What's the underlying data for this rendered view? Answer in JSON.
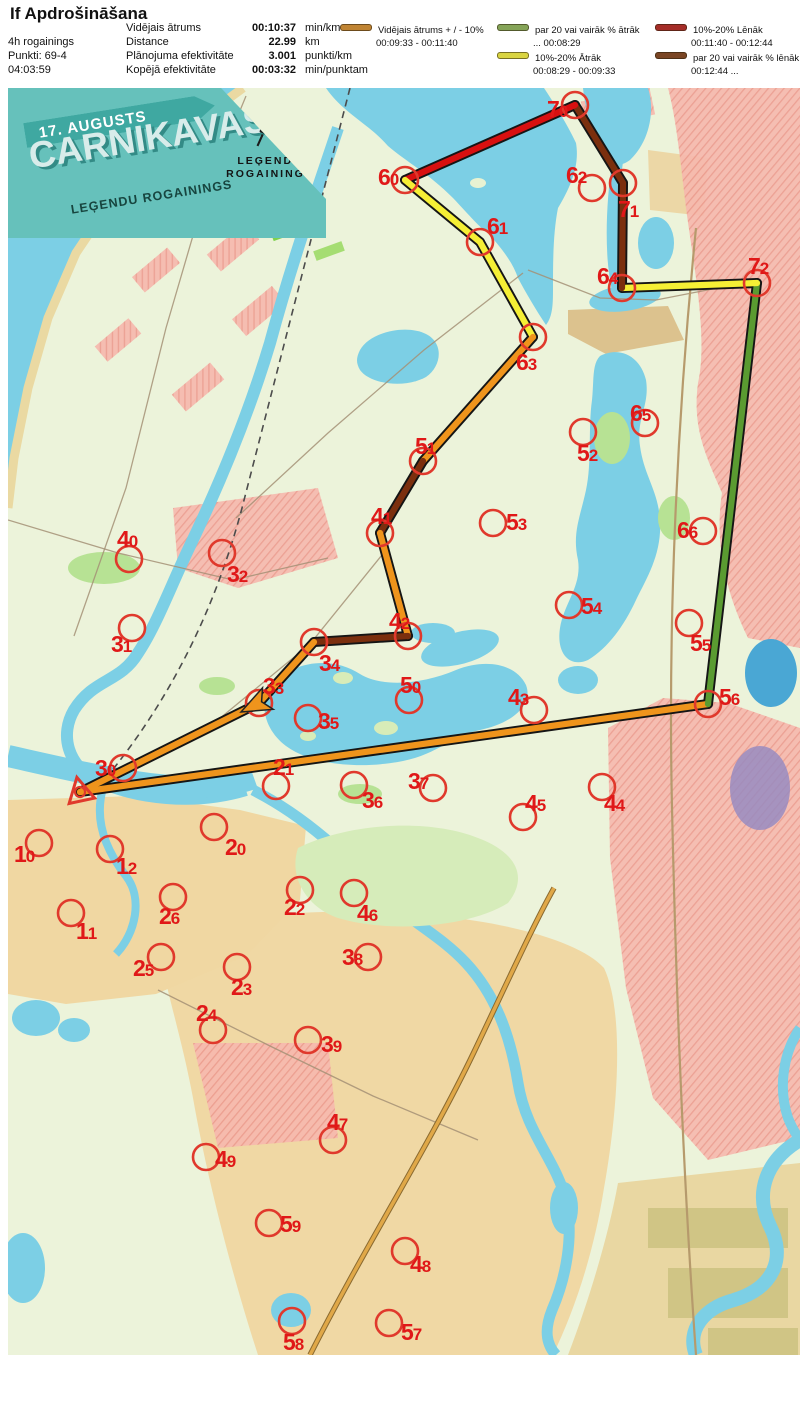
{
  "header": {
    "title": "If Apdrošināšana",
    "left": {
      "line1": "4h rogainings",
      "line2": "Punkti: 69-4",
      "line3": "04:03:59"
    },
    "stats": [
      {
        "label": "Vidējais ātrums",
        "value": "00:10:37",
        "unit": "min/km"
      },
      {
        "label": "Distance",
        "value": "22.99",
        "unit": "km"
      },
      {
        "label": "Plānojuma efektivitāte",
        "value": "3.001",
        "unit": "punkti/km"
      },
      {
        "label": "Kopējā efektivitāte",
        "value": "00:03:32",
        "unit": "min/punktam"
      }
    ],
    "legend": [
      {
        "label": "Vidējais ātrums + / - 10%",
        "range": "00:09:33   -   00:11:40",
        "color": "#c08433",
        "col": 1,
        "row": 0
      },
      {
        "label": "par 20 vai vairāk % ātrāk",
        "range": "...   00:08:29",
        "color": "#85a458",
        "col": 2,
        "row": 0
      },
      {
        "label": "10%-20% Ātrāk",
        "range": "00:08:29   -   00:09:33",
        "color": "#d9d441",
        "col": 2,
        "row": 1
      },
      {
        "label": "10%-20% Lēnāk",
        "range": "00:11:40   - 00:12:44",
        "color": "#a52d28",
        "col": 3,
        "row": 0
      },
      {
        "label": "par 20 vai vairāk % lēnāk",
        "range": "00:12:44   ...",
        "color": "#7a4524",
        "col": 3,
        "row": 1
      }
    ]
  },
  "banner": {
    "date": "17. AUGUSTS",
    "title": "CARNIKAVAS",
    "subtitle": "LEĢENDU ROGAININGS",
    "logo_line1": "LEĢENDU",
    "logo_line2": "ROGAININGS"
  },
  "map": {
    "route_colors": {
      "orange": "#ef941c",
      "yellow": "#f5ef35",
      "red": "#d81010",
      "brown": "#7b2f0e",
      "green": "#5a9b31"
    },
    "control_circle_color": "#e0392c",
    "label_color": "#e01818",
    "start": {
      "x": 72,
      "y": 704
    },
    "arrow": {
      "x": 233,
      "y": 624,
      "angle": 153.5
    },
    "controls": [
      {
        "id": "10",
        "x": 31,
        "y": 755,
        "lx": 6,
        "lby": 774
      },
      {
        "id": "11",
        "x": 63,
        "y": 825,
        "lx": 68,
        "lby": 851
      },
      {
        "id": "12",
        "x": 102,
        "y": 761,
        "lx": 108,
        "lby": 786
      },
      {
        "id": "20",
        "x": 206,
        "y": 739,
        "lx": 217,
        "lby": 767
      },
      {
        "id": "21",
        "x": 268,
        "y": 698,
        "lx": 265,
        "lby": 687
      },
      {
        "id": "22",
        "x": 292,
        "y": 802,
        "lx": 276,
        "lby": 827
      },
      {
        "id": "23",
        "x": 229,
        "y": 879,
        "lx": 223,
        "lby": 907
      },
      {
        "id": "24",
        "x": 205,
        "y": 942,
        "lx": 188,
        "lby": 933
      },
      {
        "id": "25",
        "x": 153,
        "y": 869,
        "lx": 125,
        "lby": 888
      },
      {
        "id": "26",
        "x": 165,
        "y": 809,
        "lx": 151,
        "lby": 836
      },
      {
        "id": "30",
        "x": 115,
        "y": 680,
        "lx": 87,
        "lby": 688
      },
      {
        "id": "31",
        "x": 124,
        "y": 540,
        "lx": 103,
        "lby": 564
      },
      {
        "id": "32",
        "x": 214,
        "y": 465,
        "lx": 219,
        "lby": 494
      },
      {
        "id": "33",
        "x": 251,
        "y": 615,
        "lx": 255,
        "lby": 606
      },
      {
        "id": "34",
        "x": 306,
        "y": 554,
        "lx": 311,
        "lby": 583
      },
      {
        "id": "35",
        "x": 300,
        "y": 630,
        "lx": 310,
        "lby": 641
      },
      {
        "id": "36",
        "x": 346,
        "y": 697,
        "lx": 354,
        "lby": 720
      },
      {
        "id": "37",
        "x": 425,
        "y": 700,
        "lx": 400,
        "lby": 701
      },
      {
        "id": "38",
        "x": 360,
        "y": 869,
        "lx": 334,
        "lby": 877
      },
      {
        "id": "39",
        "x": 300,
        "y": 952,
        "lx": 313,
        "lby": 964
      },
      {
        "id": "40",
        "x": 121,
        "y": 471,
        "lx": 109,
        "lby": 459
      },
      {
        "id": "41",
        "x": 372,
        "y": 445,
        "lx": 363,
        "lby": 436
      },
      {
        "id": "42",
        "x": 400,
        "y": 548,
        "lx": 381,
        "lby": 541
      },
      {
        "id": "43",
        "x": 526,
        "y": 622,
        "lx": 500,
        "lby": 617
      },
      {
        "id": "44",
        "x": 594,
        "y": 699,
        "lx": 596,
        "lby": 723
      },
      {
        "id": "45",
        "x": 515,
        "y": 729,
        "lx": 517,
        "lby": 723
      },
      {
        "id": "46",
        "x": 346,
        "y": 805,
        "lx": 349,
        "lby": 833
      },
      {
        "id": "47",
        "x": 325,
        "y": 1052,
        "lx": 319,
        "lby": 1042
      },
      {
        "id": "48",
        "x": 397,
        "y": 1163,
        "lx": 402,
        "lby": 1184
      },
      {
        "id": "49",
        "x": 198,
        "y": 1069,
        "lx": 207,
        "lby": 1079
      },
      {
        "id": "50",
        "x": 401,
        "y": 612,
        "lx": 392,
        "lby": 605
      },
      {
        "id": "51",
        "x": 415,
        "y": 373,
        "lx": 407,
        "lby": 366
      },
      {
        "id": "52",
        "x": 575,
        "y": 344,
        "lx": 569,
        "lby": 373
      },
      {
        "id": "53",
        "x": 485,
        "y": 435,
        "lx": 498,
        "lby": 442
      },
      {
        "id": "54",
        "x": 561,
        "y": 517,
        "lx": 573,
        "lby": 526
      },
      {
        "id": "55",
        "x": 681,
        "y": 535,
        "lx": 682,
        "lby": 563
      },
      {
        "id": "56",
        "x": 700,
        "y": 616,
        "lx": 711,
        "lby": 617
      },
      {
        "id": "57",
        "x": 381,
        "y": 1235,
        "lx": 393,
        "lby": 1252
      },
      {
        "id": "58",
        "x": 284,
        "y": 1233,
        "lx": 275,
        "lby": 1262
      },
      {
        "id": "59",
        "x": 261,
        "y": 1135,
        "lx": 272,
        "lby": 1144
      },
      {
        "id": "60",
        "x": 397,
        "y": 92,
        "lx": 370,
        "lby": 97
      },
      {
        "id": "61",
        "x": 472,
        "y": 154,
        "lx": 479,
        "lby": 146
      },
      {
        "id": "62",
        "x": 584,
        "y": 100,
        "lx": 558,
        "lby": 95
      },
      {
        "id": "63",
        "x": 525,
        "y": 249,
        "lx": 508,
        "lby": 282
      },
      {
        "id": "64",
        "x": 614,
        "y": 200,
        "lx": 589,
        "lby": 196
      },
      {
        "id": "65",
        "x": 637,
        "y": 335,
        "lx": 622,
        "lby": 333
      },
      {
        "id": "66",
        "x": 695,
        "y": 443,
        "lx": 669,
        "lby": 450
      },
      {
        "id": "70",
        "x": 567,
        "y": 17,
        "lx": 539,
        "lby": 29
      },
      {
        "id": "71",
        "x": 615,
        "y": 95,
        "lx": 610,
        "lby": 129
      },
      {
        "id": "72",
        "x": 749,
        "y": 195,
        "lx": 740,
        "lby": 186
      }
    ],
    "route": [
      {
        "from": "start",
        "to": "56",
        "color": "orange"
      },
      {
        "from": "56",
        "to": "72",
        "color": "green"
      },
      {
        "from": "72",
        "to": "64",
        "color": "yellow"
      },
      {
        "from": "64",
        "to": "71",
        "color": "brown"
      },
      {
        "from": "71",
        "to": "70",
        "color": "brown"
      },
      {
        "from": "70",
        "to": "60",
        "color": "red"
      },
      {
        "from": "60",
        "to": "61",
        "color": "yellow"
      },
      {
        "from": "61",
        "to": "63",
        "color": "yellow"
      },
      {
        "from": "63",
        "to": "51",
        "color": "orange"
      },
      {
        "from": "51",
        "to": "41",
        "color": "brown"
      },
      {
        "from": "41",
        "to": "42",
        "color": "orange"
      },
      {
        "from": "42",
        "to": "34",
        "color": "brown"
      },
      {
        "from": "34",
        "to": "33",
        "color": "orange"
      },
      {
        "from": "33",
        "to": "start",
        "color": "orange",
        "arrow": true
      }
    ]
  }
}
